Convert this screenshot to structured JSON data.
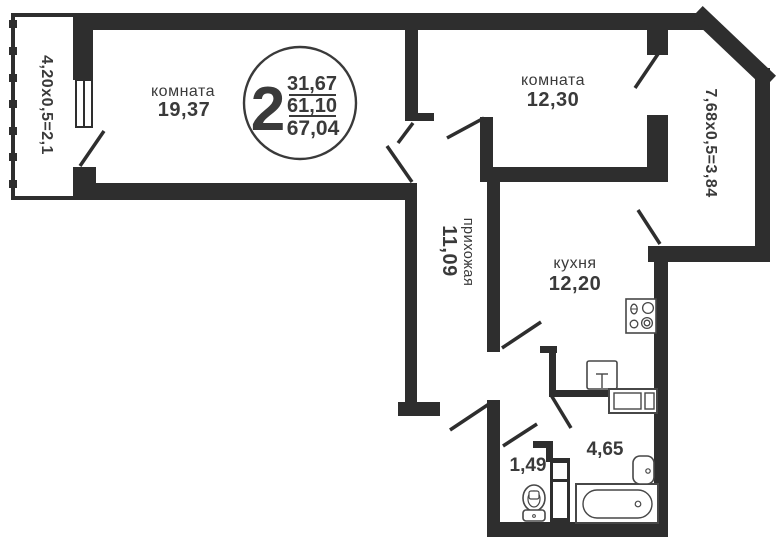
{
  "plan": {
    "badge": {
      "rooms_count": "2",
      "living_area": "31,67",
      "heated_area": "61,10",
      "total_area": "67,04"
    },
    "room1": {
      "name": "комната",
      "area": "19,37"
    },
    "room2": {
      "name": "комната",
      "area": "12,30"
    },
    "hallway": {
      "name": "прихожая",
      "area": "11,09"
    },
    "kitchen": {
      "name": "кухня",
      "area": "12,20"
    },
    "bathroom": {
      "area": "4,65"
    },
    "wc": {
      "area": "1,49"
    },
    "balcony_left": {
      "dimensions": "4,20х0,5=2,1"
    },
    "balcony_right": {
      "dimensions": "7,68х0,5=3,84"
    },
    "colors": {
      "wall": "#2e2e2e",
      "text": "#3a3a3a",
      "background": "#ffffff"
    }
  }
}
